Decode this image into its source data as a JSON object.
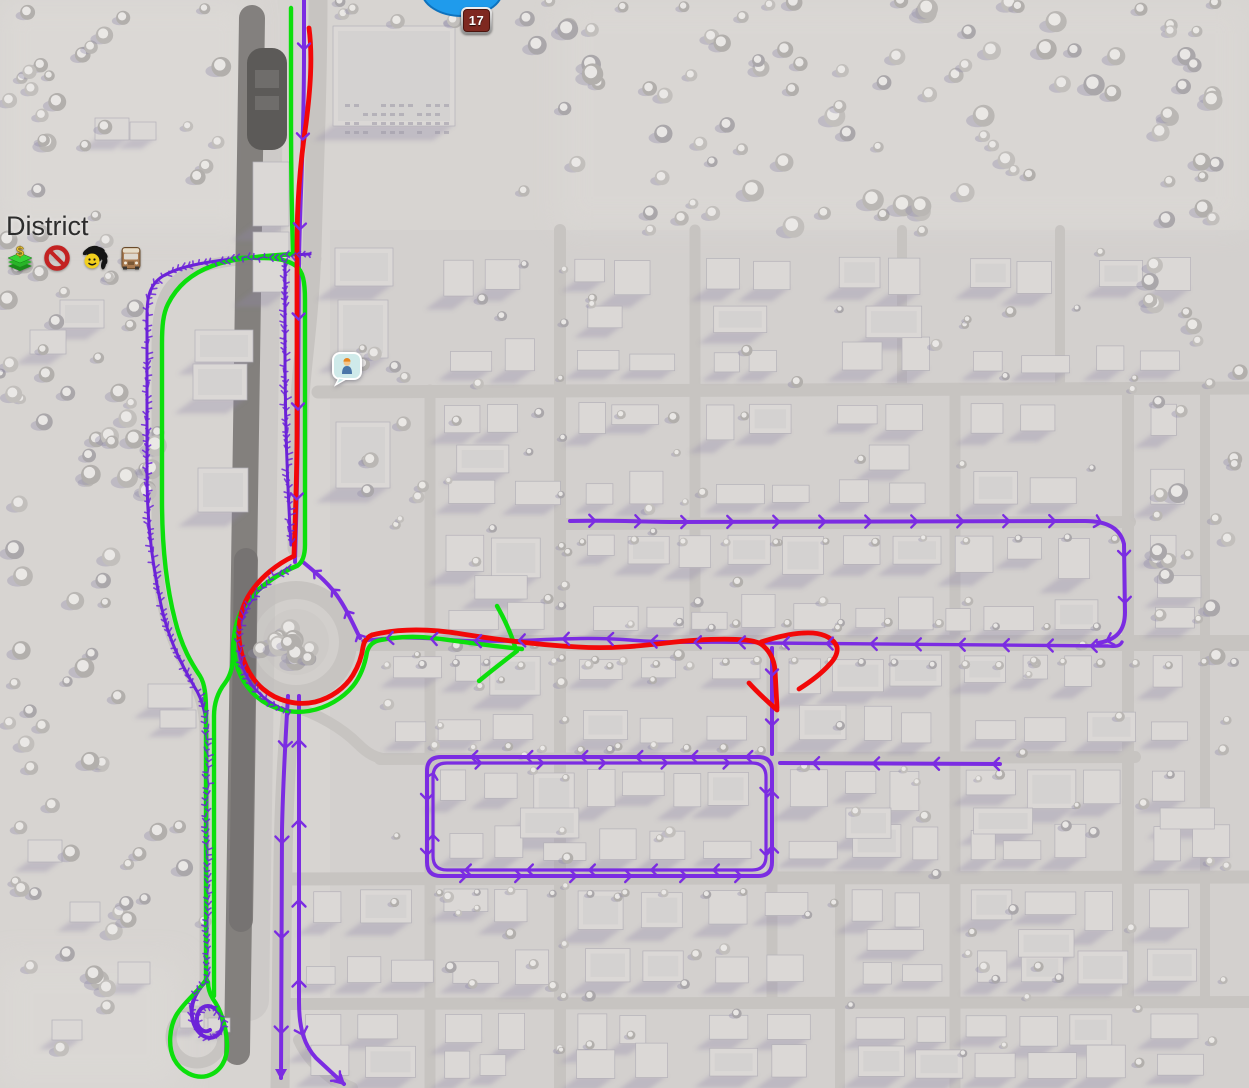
{
  "hud": {
    "district": {
      "label": "District"
    },
    "road_badge": {
      "number": "17"
    },
    "policy_icons": [
      {
        "name": "tax-policy-icon",
        "glyph": "$"
      },
      {
        "name": "ban-policy-icon"
      },
      {
        "name": "recreation-policy-icon"
      },
      {
        "name": "bus-policy-icon"
      }
    ],
    "citizen_bubble": {
      "icon": "citizen-icon"
    }
  },
  "routes": {
    "transit": {
      "color": "#7b2ce2"
    },
    "pedestrian": {
      "color": "#6c23d8"
    },
    "green": {
      "color": "#0cdf0c"
    },
    "red": {
      "color": "#f20808"
    }
  },
  "map_colors": {
    "terrain": "#d7d4d1",
    "terrain_light": "#dedbd8",
    "road": "#c7c4c1",
    "rail": "#7e7b79",
    "rail_dark": "#5c5a58",
    "building": "#dbd8d6",
    "building_edge": "#b4b1b8",
    "shadow": "#8f8aa8",
    "tree_snow": "#eceae8",
    "water": "#1f9bec"
  }
}
